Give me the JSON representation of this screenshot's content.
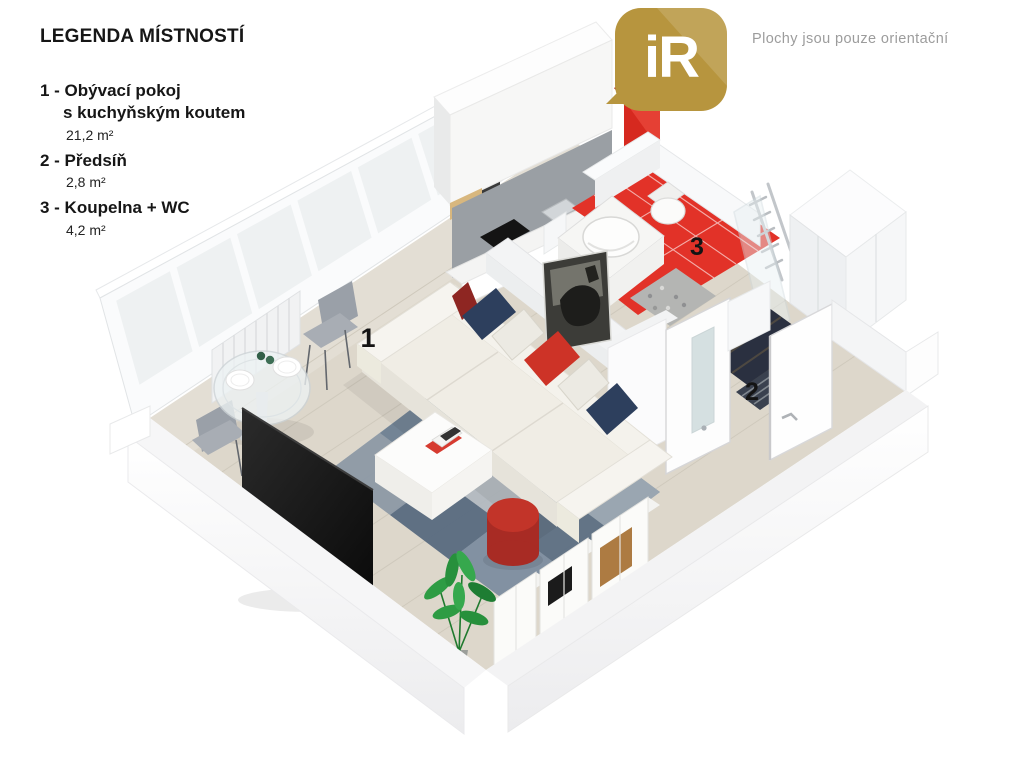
{
  "legend": {
    "title": "LEGENDA MÍSTNOSTÍ",
    "items": [
      {
        "label": "1 - Obývací pokoj",
        "label2": "s kuchyňským koutem",
        "area": "21,2 m²"
      },
      {
        "label": "2 - Předsíň",
        "area": "2,8 m²"
      },
      {
        "label": "3 - Koupelna + WC",
        "area": "4,2 m²"
      }
    ]
  },
  "logo": {
    "text": "iR"
  },
  "watermark": {
    "text": "Plochy jsou pouze orientační"
  },
  "floorplan": {
    "room_labels": [
      {
        "id": "1"
      },
      {
        "id": "2"
      },
      {
        "id": "3"
      }
    ]
  },
  "colors": {
    "brand_gold": "#b7953e",
    "accent_red": "#d6291f",
    "accent_red_dark": "#a81f17",
    "bath_floor_red": "#e23228",
    "hall_floor_dark": "#2a3040",
    "navy": "#2d3f5d",
    "pillow_red": "#cd3327",
    "pillow_darkred": "#8e2622",
    "pouf_red": "#c23429",
    "pouf_red_dark": "#a82b24",
    "watermark_gray": "#8f8f8f"
  }
}
